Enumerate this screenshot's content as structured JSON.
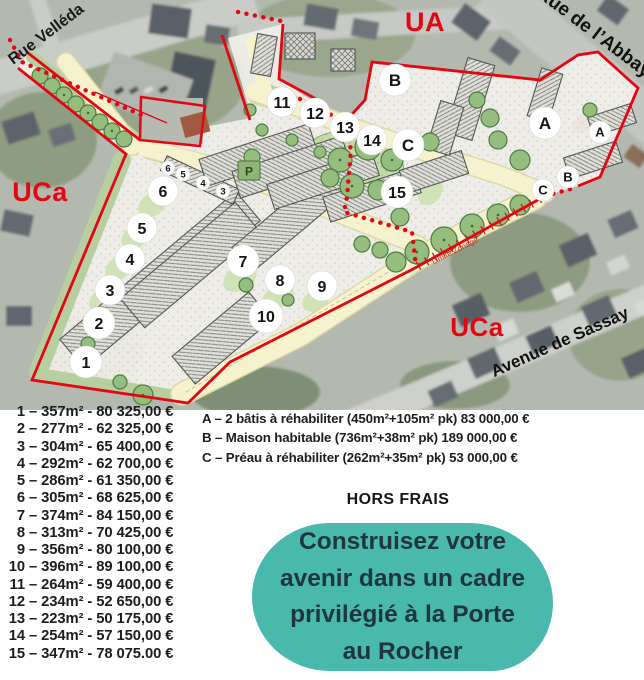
{
  "map": {
    "zone_color": "#e30613",
    "zone_labels": [
      {
        "name": "zone-label-ua",
        "text": "UA",
        "x": 425,
        "y": 31,
        "size": 27
      },
      {
        "name": "zone-label-uca-left",
        "text": "UCa",
        "x": 40,
        "y": 201,
        "size": 27
      },
      {
        "name": "zone-label-uca-right",
        "text": "UCa",
        "x": 477,
        "y": 336,
        "size": 26
      }
    ],
    "street_labels": [
      {
        "name": "street-label-rue-velleda",
        "text": "Rue Velléda",
        "x": 49,
        "y": 38,
        "rotate": -37,
        "size": 16,
        "color": "#1a1a1a",
        "weight": 700
      },
      {
        "name": "street-label-rue-de-l-abbaye",
        "text": "Rue de l’Abbaye",
        "x": 595,
        "y": 40,
        "rotate": 37,
        "size": 19,
        "color": "#111111",
        "weight": 700
      },
      {
        "name": "street-label-avenue-de-sassay",
        "text": "Avenue de Sassay",
        "x": 562,
        "y": 347,
        "rotate": -24,
        "size": 17,
        "color": "#111111",
        "weight": 700
      },
      {
        "name": "boundary-label-limite-zonage",
        "text": "Limite Zonage",
        "x": 456,
        "y": 253,
        "rotate": -27,
        "size": 8,
        "color": "#cc3322",
        "weight": 400
      }
    ],
    "parking_label": "P",
    "markers": [
      {
        "label": "1",
        "x": 86,
        "y": 362,
        "r": 16,
        "fs": 16
      },
      {
        "label": "2",
        "x": 99,
        "y": 323,
        "r": 16,
        "fs": 16
      },
      {
        "label": "3",
        "x": 110,
        "y": 290,
        "r": 15,
        "fs": 16
      },
      {
        "label": "4",
        "x": 130,
        "y": 259,
        "r": 15,
        "fs": 16
      },
      {
        "label": "5",
        "x": 142,
        "y": 228,
        "r": 15,
        "fs": 16
      },
      {
        "label": "6",
        "x": 163,
        "y": 191,
        "r": 15,
        "fs": 16
      },
      {
        "label": "7",
        "x": 243,
        "y": 261,
        "r": 16,
        "fs": 16
      },
      {
        "label": "8",
        "x": 280,
        "y": 280,
        "r": 15,
        "fs": 16
      },
      {
        "label": "9",
        "x": 322,
        "y": 286,
        "r": 15,
        "fs": 16
      },
      {
        "label": "10",
        "x": 266,
        "y": 316,
        "r": 17,
        "fs": 16
      },
      {
        "label": "11",
        "x": 282,
        "y": 102,
        "r": 15,
        "fs": 16
      },
      {
        "label": "12",
        "x": 315,
        "y": 113,
        "r": 15,
        "fs": 16
      },
      {
        "label": "13",
        "x": 345,
        "y": 127,
        "r": 15,
        "fs": 16
      },
      {
        "label": "14",
        "x": 372,
        "y": 140,
        "r": 15,
        "fs": 16
      },
      {
        "label": "15",
        "x": 397,
        "y": 192,
        "r": 16,
        "fs": 16
      },
      {
        "label": "A",
        "x": 545,
        "y": 123,
        "r": 16,
        "fs": 17
      },
      {
        "label": "B",
        "x": 395,
        "y": 80,
        "r": 16,
        "fs": 17
      },
      {
        "label": "C",
        "x": 408,
        "y": 145,
        "r": 16,
        "fs": 17
      },
      {
        "label": "A",
        "x": 600,
        "y": 132,
        "r": 11,
        "fs": 13
      },
      {
        "label": "B",
        "x": 568,
        "y": 177,
        "r": 11,
        "fs": 13
      },
      {
        "label": "C",
        "x": 543,
        "y": 190,
        "r": 11,
        "fs": 13
      },
      {
        "label": "6",
        "x": 168,
        "y": 168,
        "r": 7,
        "fs": 9.5
      },
      {
        "label": "5",
        "x": 183,
        "y": 174,
        "r": 7,
        "fs": 9.5
      },
      {
        "label": "4",
        "x": 203,
        "y": 183,
        "r": 7,
        "fs": 9.5
      },
      {
        "label": "3",
        "x": 223,
        "y": 191,
        "r": 7,
        "fs": 9.5
      }
    ]
  },
  "legend": {
    "num_sep": "–",
    "price_sep": "-",
    "lots": [
      {
        "num": "1",
        "area": "357m²",
        "price": "80 325,00 €"
      },
      {
        "num": "2",
        "area": "277m²",
        "price": "62 325,00 €"
      },
      {
        "num": "3",
        "area": "304m²",
        "price": "65 400,00 €"
      },
      {
        "num": "4",
        "area": "292m²",
        "price": "62 700,00 €"
      },
      {
        "num": "5",
        "area": "286m²",
        "price": "61 350,00 €"
      },
      {
        "num": "6",
        "area": "305m²",
        "price": "68 625,00 €"
      },
      {
        "num": "7",
        "area": "374m²",
        "price": "84 150,00 €"
      },
      {
        "num": "8",
        "area": "313m²",
        "price": "70 425,00 €"
      },
      {
        "num": "9",
        "area": "356m²",
        "price": "80 100,00 €"
      },
      {
        "num": "10",
        "area": "396m²",
        "price": "89 100,00 €"
      },
      {
        "num": "11",
        "area": "264m²",
        "price": "59 400,00 €"
      },
      {
        "num": "12",
        "area": "234m²",
        "price": "52 650,00 €"
      },
      {
        "num": "13",
        "area": "223m²",
        "price": "50 175,00 €"
      },
      {
        "num": "14",
        "area": "254m²",
        "price": "57 150,00 €"
      },
      {
        "num": "15",
        "area": "347m²",
        "price": "78 075.00 €"
      }
    ],
    "buildings": [
      {
        "code": "A",
        "desc": "2 bâtis à réhabiliter (450m²+105m² pk)",
        "price": "83 000,00 €"
      },
      {
        "code": "B",
        "desc": "Maison habitable (736m²+38m² pk)",
        "price": "189 000,00 €"
      },
      {
        "code": "C",
        "desc": "Préau à réhabiliter (262m²+35m² pk)",
        "price": "53 000,00 €"
      }
    ]
  },
  "notes": {
    "fees": "HORS FRAIS"
  },
  "cta": {
    "bg_color": "#49b8ad",
    "text_color": "#20363e",
    "lines": [
      "Construisez votre",
      "avenir dans un cadre",
      "privilégié à la Porte",
      "au Rocher"
    ]
  }
}
